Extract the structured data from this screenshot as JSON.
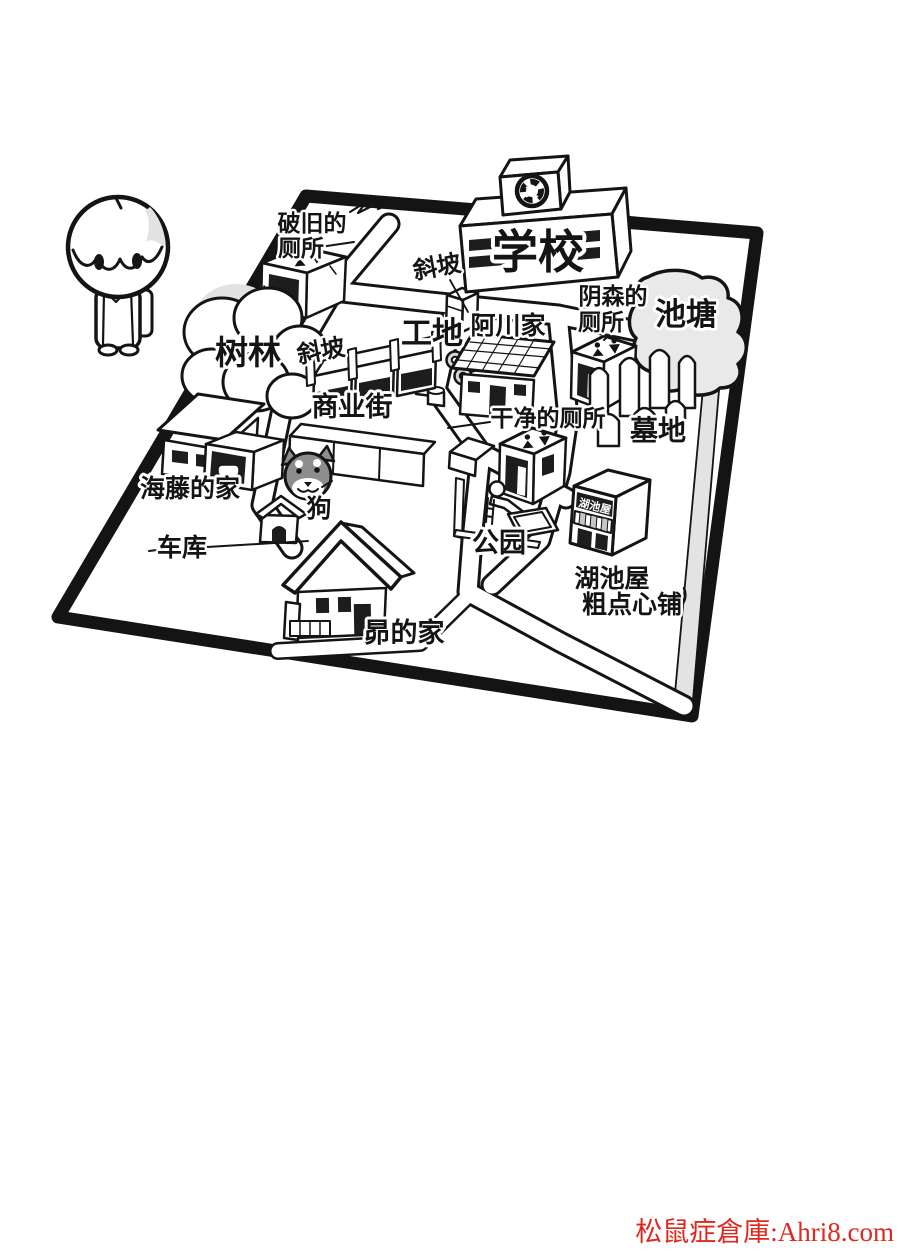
{
  "watermark": {
    "text": "松鼠症倉庫:Ahri8.com",
    "color": "#e0281e"
  },
  "map": {
    "labels": {
      "school": "学校",
      "school_emblem": "文",
      "old_toilet_line1": "破旧的",
      "old_toilet_line2": "厕所",
      "creepy_toilet_line1": "阴森的",
      "creepy_toilet_line2": "厕所",
      "clean_toilet": "干净的厕所",
      "pond": "池塘",
      "cemetery": "墓地",
      "forest": "树林",
      "slope_upper": "斜坡",
      "slope_lower": "斜坡",
      "construction_site": "工地",
      "akawa_house": "阿川家",
      "shopping_street": "商业街",
      "kaito_house": "海藤的家",
      "garage": "车库",
      "dog": "狗",
      "park": "公园",
      "subaru_house": "昴的家",
      "snack_shop_sign": "湖池屋",
      "snack_shop_line1": "湖池屋",
      "snack_shop_line2": "粗点心铺"
    },
    "colors": {
      "ink": "#141414",
      "pond_fill": "#e9e9e9",
      "road_shade": "#e3e3e3",
      "dog_fur": "#8d8d8d"
    }
  }
}
